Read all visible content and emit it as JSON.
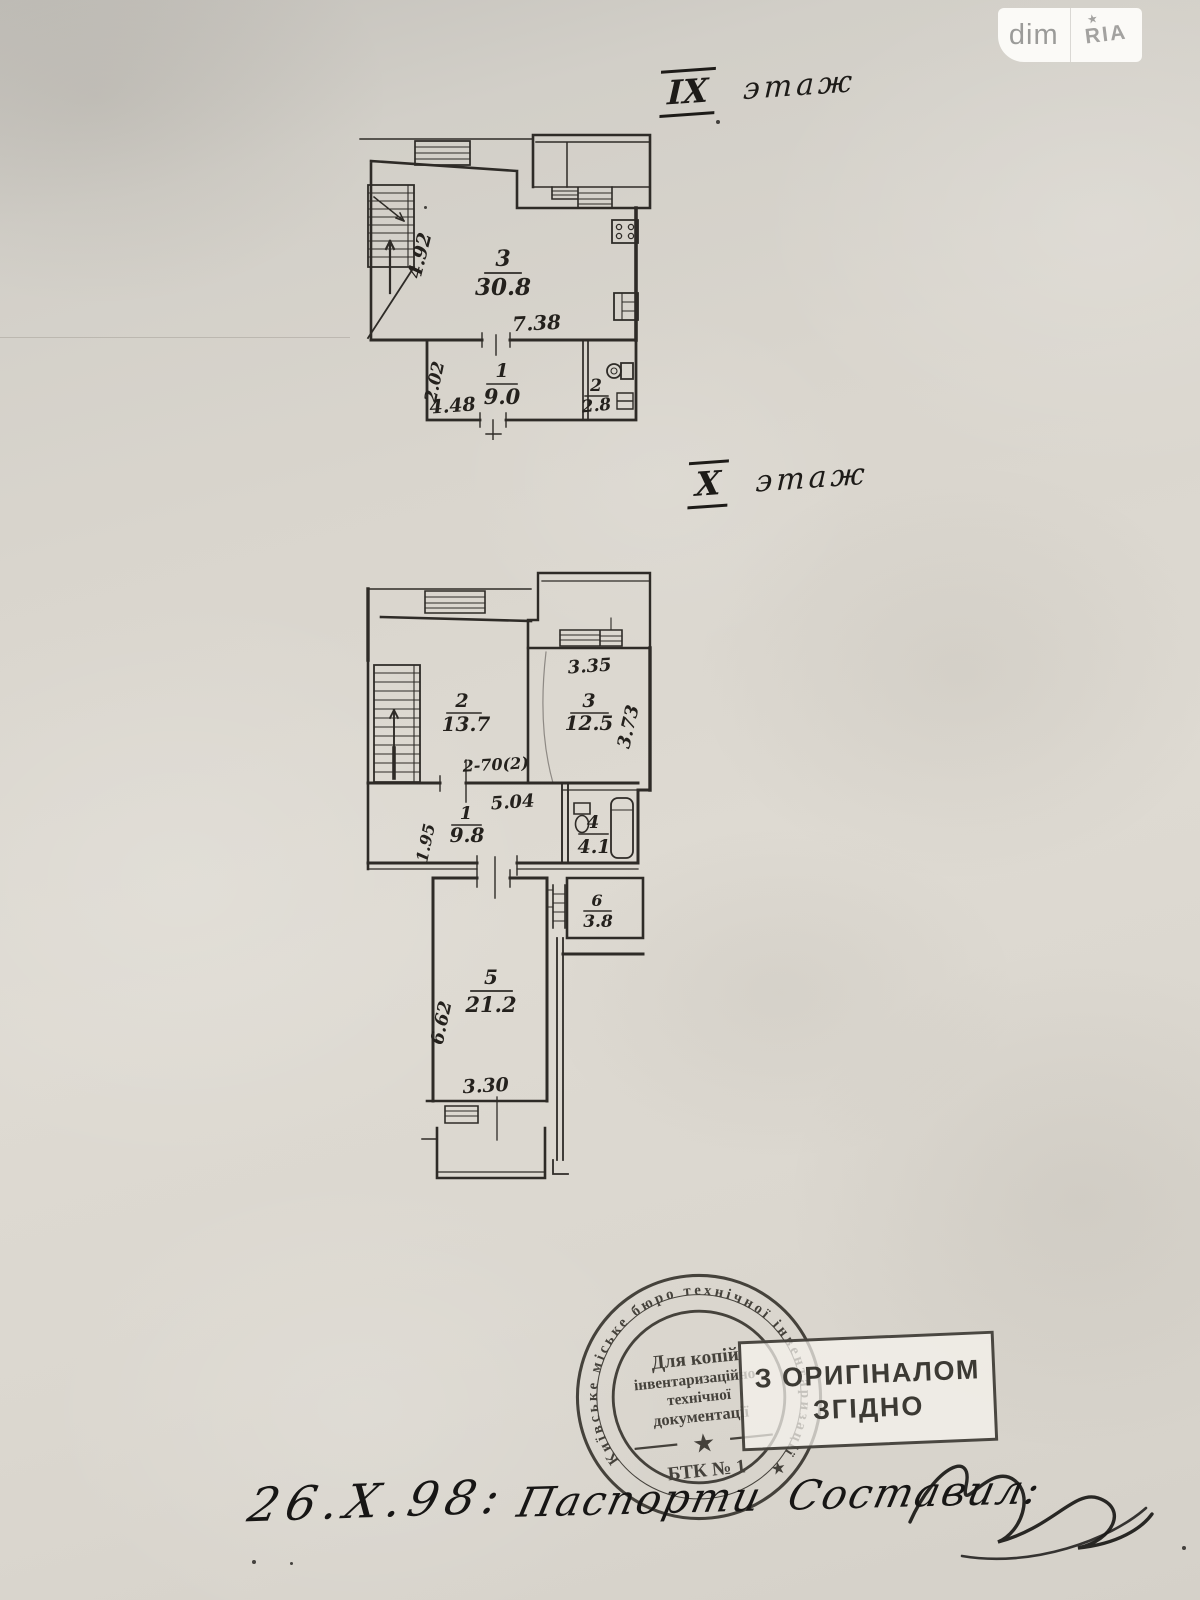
{
  "watermark": {
    "left": "dim",
    "right": "RIA",
    "star": "★"
  },
  "plan_ix": {
    "title_numeral": "IX",
    "title_word": "этаж",
    "rooms": {
      "r3": {
        "no": "3",
        "area": "30.8"
      },
      "r1": {
        "no": "1",
        "area": "9.0"
      },
      "r2": {
        "no": "2",
        "area": "2.8"
      }
    },
    "dims": {
      "width_top": "7.38",
      "height_left": "4.92",
      "r1_width": "4.48",
      "r1_height": "2.02"
    }
  },
  "plan_x": {
    "title_numeral": "X",
    "title_word": "этаж",
    "rooms": {
      "r2": {
        "no": "2",
        "area": "13.7"
      },
      "r3": {
        "no": "3",
        "area": "12.5"
      },
      "r1": {
        "no": "1",
        "area": "9.8"
      },
      "r4": {
        "no": "4",
        "area": "4.1"
      },
      "r5": {
        "no": "5",
        "area": "21.2"
      },
      "r6": {
        "no": "6",
        "area": "3.8"
      }
    },
    "dims": {
      "r3_width": "3.35",
      "r3_height": "3.73",
      "r2_note": "2-70(2)",
      "r1_width": "5.04",
      "r1_height": "1.95",
      "r5_height": "6.62",
      "r5_width": "3.30"
    }
  },
  "stamp_round": {
    "ring_text": "Київське міське бюро технічної інвентаризації ★",
    "line1": "Для копій",
    "line2": "інвентаризаційно-",
    "line3": "технічної",
    "line4": "документації",
    "star": "★",
    "bottom": "БТК № 1"
  },
  "stamp_rect": {
    "line1": "З ОРИГІНАЛОМ",
    "line2": "ЗГІДНО"
  },
  "handwriting": {
    "date": "26.X.98:",
    "caption": "Паспорти Составил:"
  }
}
